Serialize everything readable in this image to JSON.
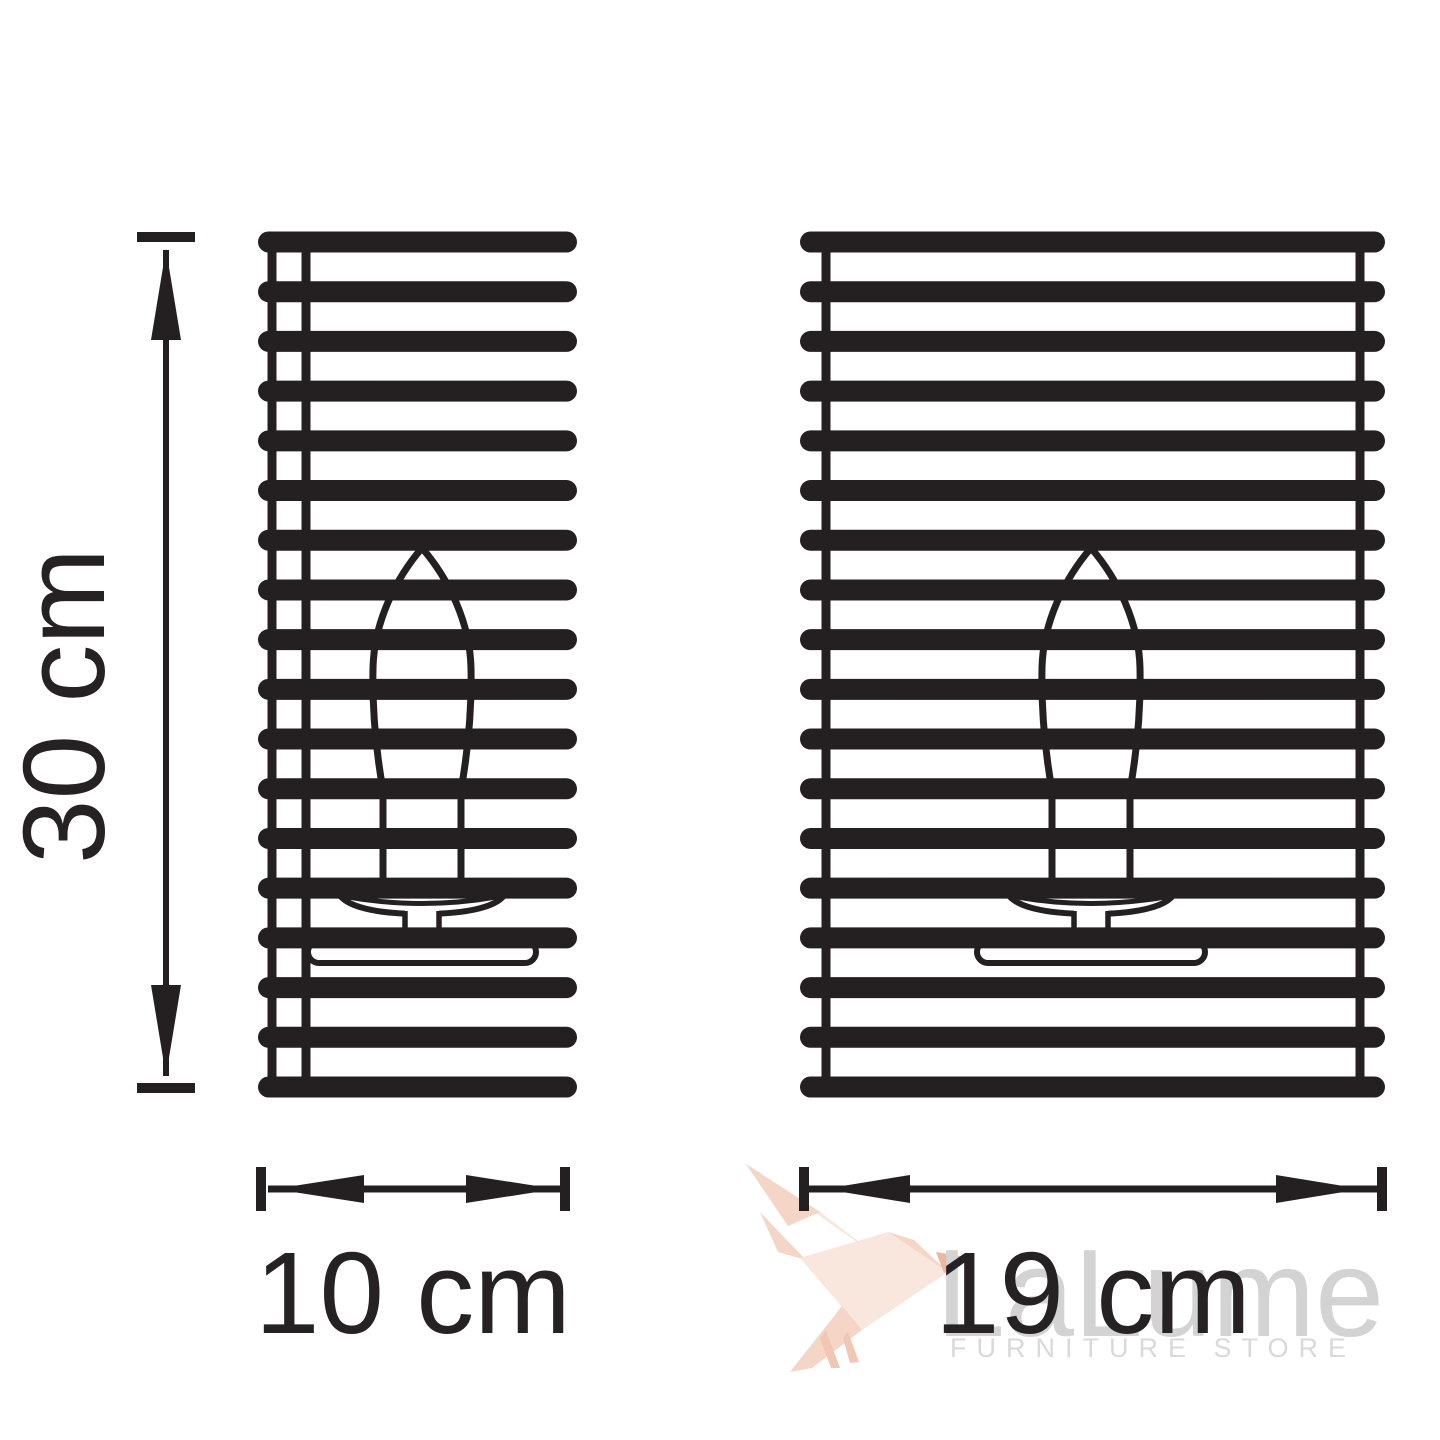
{
  "title": "Wall sconce dimension drawing",
  "colors": {
    "ink": "#242021",
    "label_text": "#262223",
    "white": "#ffffff",
    "watermark_gray": "#d3d3d3",
    "watermark_gray_light": "#d9d9d9",
    "bird_light": "#f9e6dc",
    "bird_mid": "#f4d5c6",
    "bird_dark": "#efc7b4",
    "bird_accent": "#ecb79e"
  },
  "dimensions": {
    "height": {
      "label": "30 cm",
      "value_cm": 30
    },
    "width_small": {
      "label": "10 cm",
      "value_cm": 10
    },
    "width_large": {
      "label": "19 cm",
      "value_cm": 19
    }
  },
  "lamps": {
    "left": {
      "name": "slatted sconce front view, 10 cm wide",
      "slat_count": 18
    },
    "right": {
      "name": "slatted sconce front view, 19 cm wide",
      "slat_count": 18
    }
  },
  "watermark": {
    "brand": "LaLume",
    "tagline": "FURNITURE STORE"
  }
}
